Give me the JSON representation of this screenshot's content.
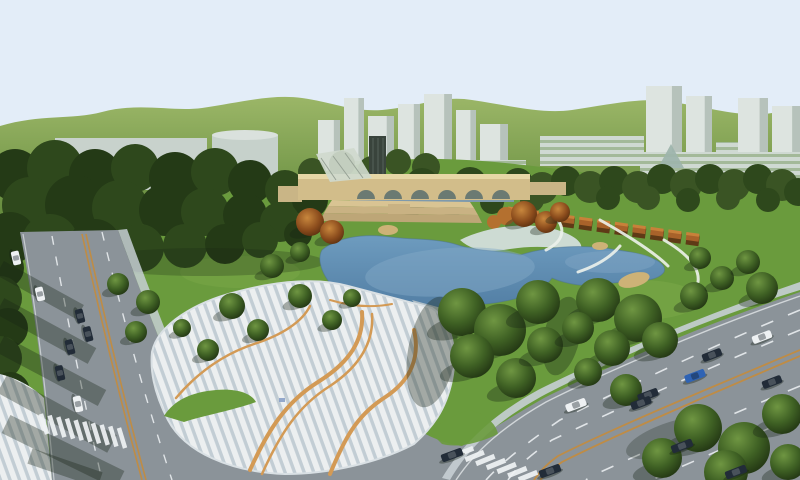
{
  "colors": {
    "sky": "#e3edf8",
    "hill_hi": "#9cb768",
    "hill_lo": "#557f31",
    "lawn": "#6a9b3d",
    "lawn_light": "#82ad4e",
    "forest_shades": [
      "#243a16",
      "#2e481c",
      "#3a5424"
    ],
    "water_hi": "#6f9dc0",
    "water_lo": "#517da3",
    "water_sheen": "#86abc8",
    "beach": "#d3dedb",
    "sand": "#cdb277",
    "plaza_light": "#eceff0",
    "plaza_blue": "#c2cdd4",
    "plaza_orange": "#d39a55",
    "road": "#8b9399",
    "curb": "#c6cfd4",
    "lane_white": "#eff2f4",
    "lane_orange": "#bf8c45",
    "bridge_tan": "#d2bd8a",
    "bridge_top": "#e6d7a6",
    "arch_dark": "#6b7a72",
    "under_water": "#7e9aad",
    "wall_tan": "#c9b586",
    "terrace1": "#d9c493",
    "terrace2": "#c9b283",
    "terrace3": "#bda677",
    "glass_roof": "#cfd9cd",
    "tower_dark": "#39443c",
    "pergola": "#a8622a",
    "pergola_dark": "#5f3a16",
    "pergola_hi": "#c8813a",
    "pavilion": "#b4702f",
    "building_low": "#c8d2cc",
    "building_tower": "#dde4e0",
    "building_shade": "#b6c2bb",
    "building_cyl": "#c6d1cb",
    "building_cap": "#dae1dd",
    "building_pyramid": "#9db4ab",
    "building_base_strip": "#c3ccc5",
    "ramp": "#b9c4cb",
    "path_white": "#edf2ec",
    "shadow": "rgba(22,36,20,0.34)",
    "car": {
      "dark": "#222c38",
      "white": "#eef1f3",
      "blue": "#2f63b4"
    }
  },
  "scene": {
    "buildings": [
      {
        "x": 55,
        "y": 138,
        "w": 152,
        "h": 52,
        "kind": "low"
      },
      {
        "x": 212,
        "y": 130,
        "w": 66,
        "h": 56,
        "kind": "cyl"
      },
      {
        "x": 318,
        "y": 120,
        "w": 22,
        "h": 58,
        "kind": "tower"
      },
      {
        "x": 344,
        "y": 98,
        "w": 20,
        "h": 80,
        "kind": "tower"
      },
      {
        "x": 368,
        "y": 116,
        "w": 26,
        "h": 66,
        "kind": "tower"
      },
      {
        "x": 398,
        "y": 104,
        "w": 22,
        "h": 74,
        "kind": "tower"
      },
      {
        "x": 424,
        "y": 94,
        "w": 28,
        "h": 88,
        "kind": "tower"
      },
      {
        "x": 456,
        "y": 110,
        "w": 20,
        "h": 70,
        "kind": "tower"
      },
      {
        "x": 480,
        "y": 124,
        "w": 28,
        "h": 58,
        "kind": "tower"
      },
      {
        "x": 330,
        "y": 160,
        "w": 196,
        "h": 28,
        "kind": "base"
      },
      {
        "x": 540,
        "y": 136,
        "w": 104,
        "h": 30,
        "kind": "base"
      },
      {
        "x": 646,
        "y": 86,
        "w": 36,
        "h": 110,
        "kind": "tower"
      },
      {
        "x": 686,
        "y": 96,
        "w": 26,
        "h": 100,
        "kind": "tower"
      },
      {
        "x": 716,
        "y": 142,
        "w": 44,
        "h": 56,
        "kind": "base"
      },
      {
        "x": 738,
        "y": 98,
        "w": 30,
        "h": 100,
        "kind": "tower"
      },
      {
        "x": 772,
        "y": 106,
        "w": 28,
        "h": 96,
        "kind": "tower"
      },
      {
        "x": 640,
        "y": 152,
        "w": 160,
        "h": 46,
        "kind": "base"
      },
      {
        "x": 658,
        "y": 144,
        "w": 26,
        "h": 24,
        "kind": "pyramid"
      }
    ],
    "forest": [
      {
        "x": 15,
        "y": 175,
        "r": 26,
        "s": 0
      },
      {
        "x": 55,
        "y": 168,
        "r": 28,
        "s": 1
      },
      {
        "x": 95,
        "y": 175,
        "r": 26,
        "s": 0
      },
      {
        "x": 135,
        "y": 168,
        "r": 24,
        "s": 1
      },
      {
        "x": 175,
        "y": 178,
        "r": 26,
        "s": 0
      },
      {
        "x": 215,
        "y": 172,
        "r": 24,
        "s": 1
      },
      {
        "x": 250,
        "y": 182,
        "r": 22,
        "s": 0
      },
      {
        "x": 285,
        "y": 190,
        "r": 20,
        "s": 1
      },
      {
        "x": 310,
        "y": 200,
        "r": 18,
        "s": 0
      },
      {
        "x": 30,
        "y": 205,
        "r": 28,
        "s": 1
      },
      {
        "x": 75,
        "y": 205,
        "r": 30,
        "s": 0
      },
      {
        "x": 120,
        "y": 208,
        "r": 28,
        "s": 1
      },
      {
        "x": 165,
        "y": 210,
        "r": 26,
        "s": 0
      },
      {
        "x": 205,
        "y": 212,
        "r": 24,
        "s": 1
      },
      {
        "x": 245,
        "y": 215,
        "r": 22,
        "s": 0
      },
      {
        "x": 280,
        "y": 222,
        "r": 20,
        "s": 1
      },
      {
        "x": 10,
        "y": 238,
        "r": 26,
        "s": 0
      },
      {
        "x": 50,
        "y": 242,
        "r": 28,
        "s": 1
      },
      {
        "x": 95,
        "y": 245,
        "r": 26,
        "s": 0
      },
      {
        "x": 140,
        "y": 248,
        "r": 24,
        "s": 1
      },
      {
        "x": 185,
        "y": 246,
        "r": 22,
        "s": 1
      },
      {
        "x": 225,
        "y": 244,
        "r": 20,
        "s": 0
      },
      {
        "x": 260,
        "y": 240,
        "r": 18,
        "s": 1
      },
      {
        "x": 298,
        "y": 234,
        "r": 14,
        "s": 0
      },
      {
        "x": 4,
        "y": 268,
        "r": 20,
        "s": 0
      },
      {
        "x": 0,
        "y": 298,
        "r": 22,
        "s": 1
      },
      {
        "x": 8,
        "y": 328,
        "r": 20,
        "s": 0
      },
      {
        "x": 0,
        "y": 358,
        "r": 22,
        "s": 1
      },
      {
        "x": 10,
        "y": 392,
        "r": 20,
        "s": 0
      },
      {
        "x": 2,
        "y": 424,
        "r": 22,
        "s": 1
      },
      {
        "x": 16,
        "y": 452,
        "r": 20,
        "s": 0
      },
      {
        "x": 40,
        "y": 468,
        "r": 18,
        "s": 1
      },
      {
        "x": 6,
        "y": 474,
        "r": 20,
        "s": 0
      },
      {
        "x": 312,
        "y": 172,
        "r": 14,
        "s": 2
      },
      {
        "x": 342,
        "y": 164,
        "r": 13,
        "s": 2
      },
      {
        "x": 372,
        "y": 170,
        "r": 14,
        "s": 2
      },
      {
        "x": 398,
        "y": 162,
        "r": 13,
        "s": 2
      },
      {
        "x": 426,
        "y": 167,
        "r": 14,
        "s": 2
      },
      {
        "x": 398,
        "y": 192,
        "r": 16,
        "s": 2
      },
      {
        "x": 422,
        "y": 185,
        "r": 17,
        "s": 1
      },
      {
        "x": 446,
        "y": 192,
        "r": 16,
        "s": 2
      },
      {
        "x": 470,
        "y": 184,
        "r": 17,
        "s": 1
      },
      {
        "x": 494,
        "y": 190,
        "r": 16,
        "s": 2
      },
      {
        "x": 518,
        "y": 183,
        "r": 15,
        "s": 1
      },
      {
        "x": 542,
        "y": 188,
        "r": 16,
        "s": 2
      },
      {
        "x": 566,
        "y": 181,
        "r": 15,
        "s": 1
      },
      {
        "x": 590,
        "y": 187,
        "r": 16,
        "s": 2
      },
      {
        "x": 614,
        "y": 181,
        "r": 15,
        "s": 1
      },
      {
        "x": 638,
        "y": 187,
        "r": 16,
        "s": 2
      },
      {
        "x": 662,
        "y": 179,
        "r": 15,
        "s": 1
      },
      {
        "x": 686,
        "y": 185,
        "r": 16,
        "s": 2
      },
      {
        "x": 710,
        "y": 179,
        "r": 15,
        "s": 1
      },
      {
        "x": 734,
        "y": 185,
        "r": 16,
        "s": 2
      },
      {
        "x": 758,
        "y": 179,
        "r": 15,
        "s": 1
      },
      {
        "x": 782,
        "y": 185,
        "r": 16,
        "s": 2
      },
      {
        "x": 798,
        "y": 192,
        "r": 14,
        "s": 1
      },
      {
        "x": 412,
        "y": 203,
        "r": 13,
        "s": 1
      },
      {
        "x": 452,
        "y": 204,
        "r": 13,
        "s": 2
      },
      {
        "x": 492,
        "y": 202,
        "r": 12,
        "s": 1
      },
      {
        "x": 532,
        "y": 200,
        "r": 12,
        "s": 2
      },
      {
        "x": 608,
        "y": 198,
        "r": 12,
        "s": 1
      },
      {
        "x": 648,
        "y": 198,
        "r": 12,
        "s": 2
      },
      {
        "x": 688,
        "y": 200,
        "r": 12,
        "s": 1
      },
      {
        "x": 728,
        "y": 198,
        "r": 12,
        "s": 2
      },
      {
        "x": 768,
        "y": 200,
        "r": 12,
        "s": 1
      }
    ],
    "trees": [
      {
        "x": 232,
        "y": 306,
        "r": 13
      },
      {
        "x": 258,
        "y": 330,
        "r": 11
      },
      {
        "x": 300,
        "y": 296,
        "r": 12
      },
      {
        "x": 332,
        "y": 320,
        "r": 10
      },
      {
        "x": 208,
        "y": 350,
        "r": 11
      },
      {
        "x": 182,
        "y": 328,
        "r": 9
      },
      {
        "x": 352,
        "y": 298,
        "r": 9
      },
      {
        "x": 148,
        "y": 302,
        "r": 12
      },
      {
        "x": 118,
        "y": 284,
        "r": 11
      },
      {
        "x": 136,
        "y": 332,
        "r": 11
      },
      {
        "x": 462,
        "y": 312,
        "r": 24
      },
      {
        "x": 500,
        "y": 330,
        "r": 26
      },
      {
        "x": 538,
        "y": 302,
        "r": 22
      },
      {
        "x": 472,
        "y": 356,
        "r": 22
      },
      {
        "x": 516,
        "y": 378,
        "r": 20
      },
      {
        "x": 545,
        "y": 345,
        "r": 18
      },
      {
        "x": 598,
        "y": 300,
        "r": 22
      },
      {
        "x": 638,
        "y": 318,
        "r": 24
      },
      {
        "x": 612,
        "y": 348,
        "r": 18
      },
      {
        "x": 578,
        "y": 328,
        "r": 16
      },
      {
        "x": 660,
        "y": 340,
        "r": 18
      },
      {
        "x": 588,
        "y": 372,
        "r": 14
      },
      {
        "x": 626,
        "y": 390,
        "r": 16
      },
      {
        "x": 698,
        "y": 428,
        "r": 24
      },
      {
        "x": 744,
        "y": 448,
        "r": 26
      },
      {
        "x": 782,
        "y": 414,
        "r": 20
      },
      {
        "x": 662,
        "y": 458,
        "r": 20
      },
      {
        "x": 726,
        "y": 472,
        "r": 22
      },
      {
        "x": 788,
        "y": 462,
        "r": 18
      },
      {
        "x": 694,
        "y": 296,
        "r": 14
      },
      {
        "x": 722,
        "y": 278,
        "r": 12
      },
      {
        "x": 762,
        "y": 288,
        "r": 16
      },
      {
        "x": 700,
        "y": 258,
        "r": 11
      },
      {
        "x": 748,
        "y": 262,
        "r": 12
      },
      {
        "x": 300,
        "y": 252,
        "r": 10
      },
      {
        "x": 272,
        "y": 266,
        "r": 12
      },
      {
        "x": 310,
        "y": 222,
        "r": 14,
        "k": "a"
      },
      {
        "x": 332,
        "y": 232,
        "r": 12,
        "k": "a"
      },
      {
        "x": 524,
        "y": 214,
        "r": 13,
        "k": "a"
      },
      {
        "x": 546,
        "y": 222,
        "r": 11,
        "k": "a"
      },
      {
        "x": 560,
        "y": 212,
        "r": 10,
        "k": "a"
      }
    ],
    "cars": [
      {
        "x": 16,
        "y": 258,
        "a": 77,
        "c": "white",
        "l": 14
      },
      {
        "x": 40,
        "y": 294,
        "a": 77,
        "c": "white",
        "l": 14
      },
      {
        "x": 80,
        "y": 316,
        "a": 76,
        "c": "dark",
        "l": 14
      },
      {
        "x": 88,
        "y": 334,
        "a": 76,
        "c": "dark",
        "l": 15
      },
      {
        "x": 70,
        "y": 347,
        "a": 76,
        "c": "dark",
        "l": 15
      },
      {
        "x": 60,
        "y": 373,
        "a": 77,
        "c": "dark",
        "l": 15
      },
      {
        "x": 78,
        "y": 404,
        "a": 78,
        "c": "white",
        "l": 16
      },
      {
        "x": 762,
        "y": 337,
        "a": -21,
        "c": "white",
        "l": 20
      },
      {
        "x": 712,
        "y": 355,
        "a": -21,
        "c": "dark",
        "l": 20
      },
      {
        "x": 695,
        "y": 376,
        "a": -21,
        "c": "blue",
        "l": 21
      },
      {
        "x": 648,
        "y": 395,
        "a": -21,
        "c": "dark",
        "l": 21
      },
      {
        "x": 576,
        "y": 405,
        "a": -21,
        "c": "white",
        "l": 21
      },
      {
        "x": 641,
        "y": 403,
        "a": -21,
        "c": "dark",
        "l": 21
      },
      {
        "x": 772,
        "y": 382,
        "a": -21,
        "c": "dark",
        "l": 20
      },
      {
        "x": 452,
        "y": 455,
        "a": -20,
        "c": "dark",
        "l": 22
      },
      {
        "x": 550,
        "y": 471,
        "a": -20,
        "c": "dark",
        "l": 22
      },
      {
        "x": 682,
        "y": 446,
        "a": -21,
        "c": "dark",
        "l": 22
      },
      {
        "x": 736,
        "y": 472,
        "a": -21,
        "c": "dark",
        "l": 22
      }
    ],
    "crosswalks": [
      {
        "x": 44,
        "y": 424,
        "dx": 78,
        "dy": 14,
        "n": 10,
        "bw": 4.5,
        "bl": 21,
        "rot": -17
      },
      {
        "x": 464,
        "y": 452,
        "dx": 64,
        "dy": 24,
        "n": 7,
        "bw": 5,
        "bl": 20,
        "rot": 68
      }
    ],
    "road_shadows": [
      {
        "x1": 0,
        "y1": 268,
        "x2": 80,
        "y2": 312,
        "w": 16
      },
      {
        "x1": 0,
        "y1": 306,
        "x2": 92,
        "y2": 356,
        "w": 18
      },
      {
        "x1": 0,
        "y1": 344,
        "x2": 102,
        "y2": 398,
        "w": 18
      },
      {
        "x1": 2,
        "y1": 384,
        "x2": 112,
        "y2": 444,
        "w": 20
      },
      {
        "x1": 6,
        "y1": 424,
        "x2": 120,
        "y2": 480,
        "w": 20
      },
      {
        "x1": 30,
        "y1": 456,
        "x2": 100,
        "y2": 480,
        "w": 16
      }
    ]
  }
}
